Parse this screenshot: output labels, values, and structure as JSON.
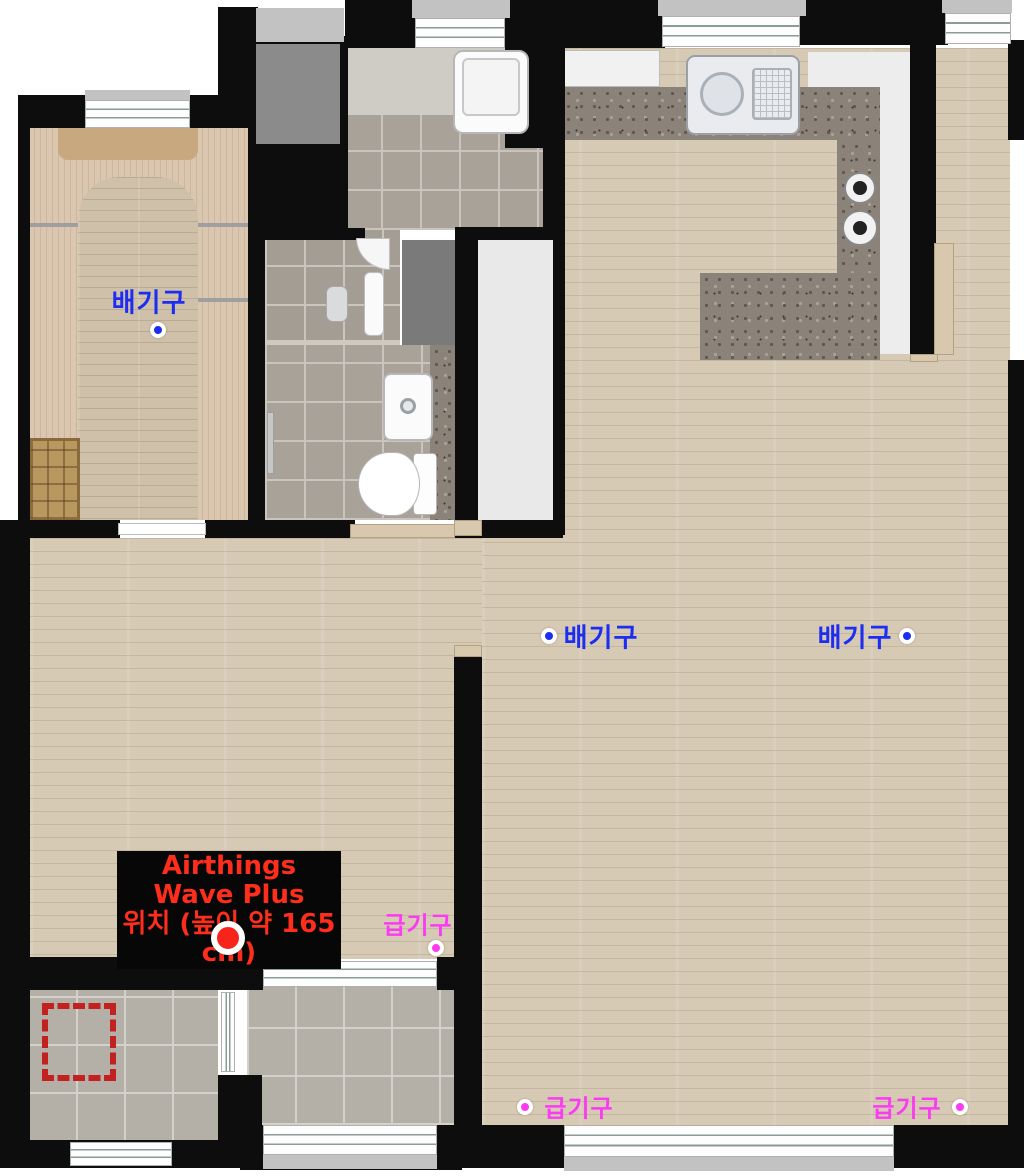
{
  "annotations": {
    "exhaust_vent": {
      "label": "배기구",
      "color": "#1d2df2"
    },
    "supply_vent": {
      "label": "급기구",
      "color": "#fb3bf4"
    },
    "device": {
      "line1": "Airthings Wave Plus",
      "line2": "위치 (높이 약 165 cm)",
      "text_color": "#ff2d1c",
      "dot_color": "#f8231a",
      "box_bg": "#070707"
    },
    "candidate_zone": {
      "border_color": "#c32020"
    }
  }
}
